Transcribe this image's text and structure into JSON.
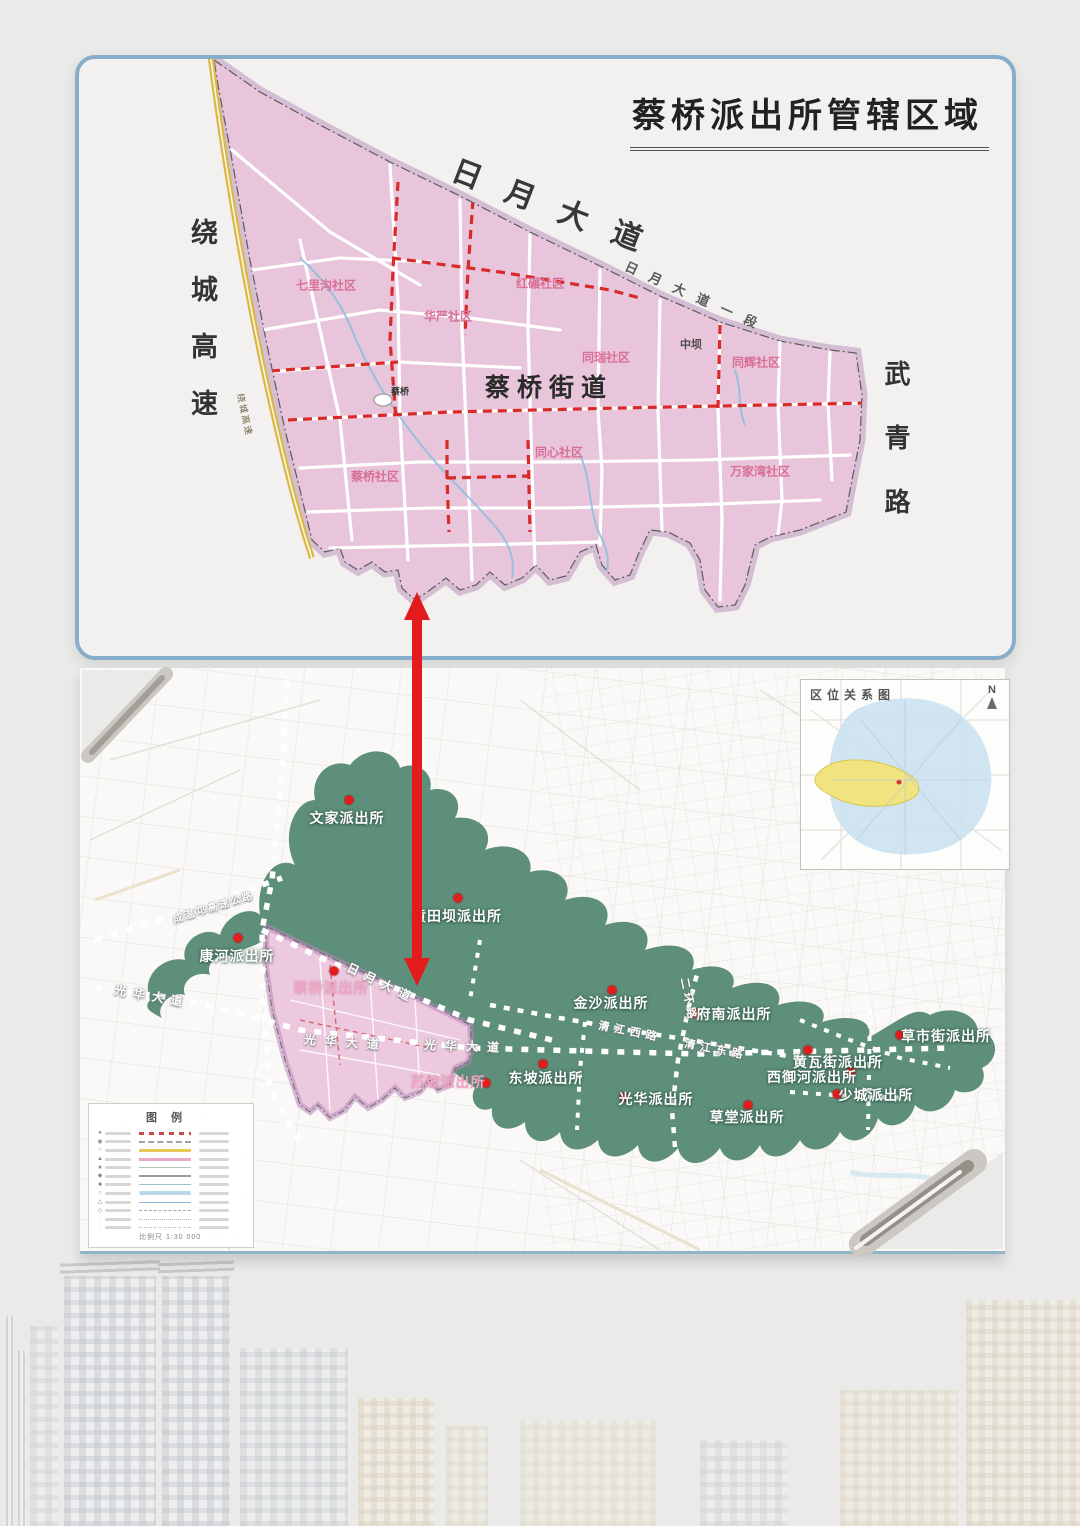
{
  "title": "蔡桥派出所管辖区域",
  "colors": {
    "card_border": "#86aecb",
    "district_pink": "#e8c5da",
    "boundary_halo": "#b17eb4",
    "jurisdiction_green": "#5d8f7a",
    "road_red_dash": "#d92a2a",
    "expressway_yellow": "#d9b84a",
    "arrow_red": "#e31b1d",
    "station_dot_red": "#e21d1d",
    "inset_city_blue": "#c8dff0",
    "inset_district_yellow": "#f1e380"
  },
  "top_map": {
    "street_label": "蔡桥街道",
    "bridge_label": "蔡桥",
    "expressway_small": "绕城高速",
    "road_labels": {
      "ring_expressway": "绕城高速",
      "riyue_avenue": "日月大道",
      "riyue_avenue_sec": "日月大道一段",
      "wuqing_road": "武青路"
    },
    "communities": [
      {
        "text": "七里沟社区",
        "x": 326,
        "y": 285
      },
      {
        "text": "红碾社区",
        "x": 540,
        "y": 283
      },
      {
        "text": "华严社区",
        "x": 448,
        "y": 316
      },
      {
        "text": "同瑞社区",
        "x": 606,
        "y": 357
      },
      {
        "text": "中坝",
        "x": 691,
        "y": 344,
        "cls": "dark",
        "size": 11
      },
      {
        "text": "同辉社区",
        "x": 756,
        "y": 362
      },
      {
        "text": "同心社区",
        "x": 559,
        "y": 452
      },
      {
        "text": "蔡桥社区",
        "x": 375,
        "y": 476
      },
      {
        "text": "万家湾社区",
        "x": 760,
        "y": 471
      }
    ]
  },
  "bottom_map": {
    "stations": [
      {
        "text": "文家派出所",
        "x": 347,
        "y": 818
      },
      {
        "text": "黄田坝派出所",
        "x": 457,
        "y": 916
      },
      {
        "text": "康河派出所",
        "x": 237,
        "y": 956
      },
      {
        "text": "蔡桥派出所",
        "x": 331,
        "y": 988,
        "cls": "st-pink"
      },
      {
        "text": "金沙派出所",
        "x": 611,
        "y": 1003
      },
      {
        "text": "府南派出所",
        "x": 734,
        "y": 1014
      },
      {
        "text": "草市街派出所",
        "x": 946,
        "y": 1036
      },
      {
        "text": "黄瓦街派出所",
        "x": 838,
        "y": 1062
      },
      {
        "text": "西御河派出所",
        "x": 812,
        "y": 1077
      },
      {
        "text": "东坡派出所",
        "x": 546,
        "y": 1078
      },
      {
        "text": "苏坡派出所",
        "x": 448,
        "y": 1082,
        "cls": "st-pink"
      },
      {
        "text": "光华派出所",
        "x": 656,
        "y": 1099
      },
      {
        "text": "草堂派出所",
        "x": 747,
        "y": 1117
      },
      {
        "text": "少城派出所",
        "x": 876,
        "y": 1095
      }
    ],
    "dots": [
      {
        "x": 349,
        "y": 800
      },
      {
        "x": 458,
        "y": 898
      },
      {
        "x": 238,
        "y": 938
      },
      {
        "x": 334,
        "y": 971
      },
      {
        "x": 612,
        "y": 990
      },
      {
        "x": 695,
        "y": 1013
      },
      {
        "x": 900,
        "y": 1035
      },
      {
        "x": 808,
        "y": 1050
      },
      {
        "x": 851,
        "y": 1072
      },
      {
        "x": 543,
        "y": 1064
      },
      {
        "x": 486,
        "y": 1083
      },
      {
        "x": 624,
        "y": 1097
      },
      {
        "x": 748,
        "y": 1105
      },
      {
        "x": 837,
        "y": 1094
      }
    ],
    "road_labels": [
      {
        "text": "成温邛高速公路",
        "x": 213,
        "y": 906,
        "rot": -17,
        "size": 10,
        "ls": 2
      },
      {
        "text": "日月大道",
        "x": 382,
        "y": 983,
        "rot": 26,
        "size": 12,
        "ls": 7
      },
      {
        "text": "光华大道",
        "x": 152,
        "y": 996,
        "rot": 10,
        "size": 12,
        "ls": 7
      },
      {
        "text": "光华大道",
        "x": 346,
        "y": 1042,
        "rot": 4,
        "size": 12,
        "ls": 9
      },
      {
        "text": "光华大道",
        "x": 466,
        "y": 1046,
        "rot": 2,
        "size": 12,
        "ls": 9
      },
      {
        "text": "清江西路",
        "x": 630,
        "y": 1031,
        "rot": 11,
        "size": 11,
        "ls": 5
      },
      {
        "text": "清江东路",
        "x": 716,
        "y": 1049,
        "rot": 11,
        "size": 11,
        "ls": 5
      },
      {
        "text": "二环路",
        "x": 689,
        "y": 1000,
        "rot": 79,
        "size": 11,
        "ls": 4
      }
    ],
    "inset": {
      "title": "区位关系图",
      "north": "N"
    },
    "legend": {
      "title": "图例",
      "scale": "比例尺  1:30 000",
      "rows": [
        {
          "sym": "●",
          "cls": "lr1"
        },
        {
          "sym": "◉",
          "cls": "lr2"
        },
        {
          "sym": "○",
          "cls": "lr3"
        },
        {
          "sym": "▲",
          "cls": "lr4"
        },
        {
          "sym": "★",
          "cls": "lr5"
        },
        {
          "sym": "◆",
          "cls": "lr6"
        },
        {
          "sym": "■",
          "cls": "lr7"
        },
        {
          "sym": "○",
          "cls": "lr8"
        },
        {
          "sym": "△",
          "cls": "lr9"
        },
        {
          "sym": "◇",
          "cls": "lr10"
        },
        {
          "sym": "·",
          "cls": "lr11"
        },
        {
          "sym": "·",
          "cls": "lr12"
        }
      ]
    }
  }
}
